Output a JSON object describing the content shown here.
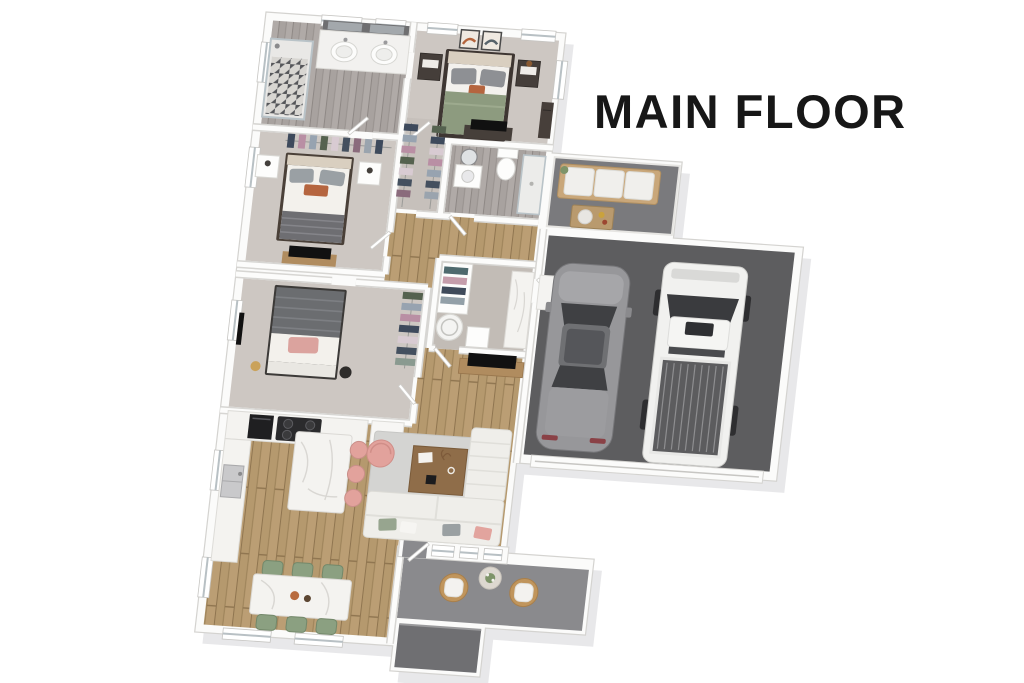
{
  "title": "MAIN FLOOR",
  "palette": {
    "background": "#ffffff",
    "title_color": "#171717",
    "wall": "#fbfbfa",
    "wall_edge": "#d4d3d0",
    "wood_floor": "#b5996e",
    "wood_floor_alt": "#bb9e74",
    "gray_wood_floor": "#a8a29f",
    "carpet": "#cdc7c2",
    "garage_floor": "#5d5d5f",
    "patio_floor": "#7a7a7d",
    "porch_floor": "#8a8a8d",
    "step": "#6f6f72",
    "rug": "#d4d4d2",
    "marble": "#f4f3f0",
    "sofa": "#efeeea",
    "bed_green": "#8d9b7f",
    "bed_dark_gray": "#6b6d70",
    "accent_rust": "#b5653f",
    "accent_pink": "#e2a29c",
    "chair_green": "#8ba081",
    "stool_pink": "#e2a29c",
    "wood_furniture": "#b08c5f",
    "car_gray": "#97979a",
    "truck_white": "#f1f1ef",
    "tv_black": "#111111"
  },
  "rooms": [
    "primary-bathroom",
    "walk-in-closet",
    "primary-bedroom",
    "ensuite-bathroom",
    "bedroom-2",
    "bedroom-3",
    "hallway",
    "laundry-room",
    "kitchen",
    "dining-area",
    "living-room",
    "front-porch",
    "entry-step",
    "garage",
    "patio"
  ],
  "furniture": [
    "double-vanity",
    "tiled-shower",
    "king-bed-green",
    "nightstands",
    "wall-art",
    "tv-console",
    "queen-bed-white",
    "queen-bed-gray",
    "clothes-racks",
    "washer",
    "cooktop",
    "kitchen-island",
    "bar-stools",
    "dining-table",
    "dining-chairs",
    "sectional-sofa",
    "coffee-table",
    "round-armchair",
    "area-rug",
    "outdoor-sofa",
    "outdoor-coffee-table",
    "patio-chairs",
    "planter-table",
    "gray-sedan",
    "white-pickup-truck"
  ]
}
